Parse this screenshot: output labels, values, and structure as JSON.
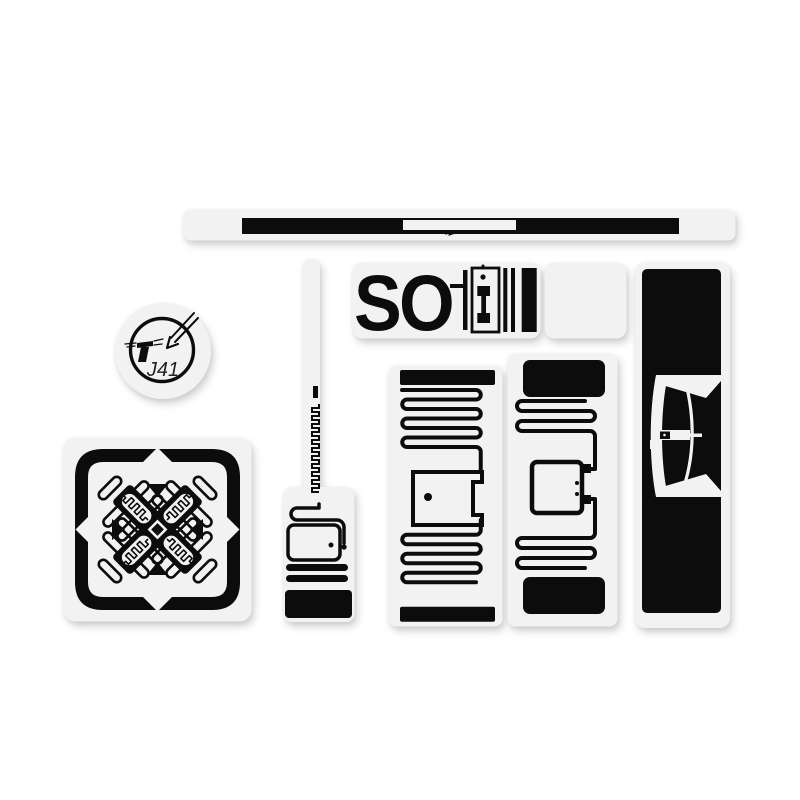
{
  "colors": {
    "background": "#ffffff",
    "label": "#f2f2f2",
    "ink": "#0c0c0c",
    "text_dark": "#1f1f1f"
  },
  "texts": {
    "so_label": "SO",
    "circle_code": "J41"
  },
  "items": [
    {
      "id": "long-strip-inlay"
    },
    {
      "id": "circular-tag-j41"
    },
    {
      "id": "so-inlay-pair"
    },
    {
      "id": "square-cross-inlay"
    },
    {
      "id": "long-stem-inlay"
    },
    {
      "id": "meander-inlay-a"
    },
    {
      "id": "meander-inlay-b"
    },
    {
      "id": "tall-black-inlay"
    }
  ]
}
